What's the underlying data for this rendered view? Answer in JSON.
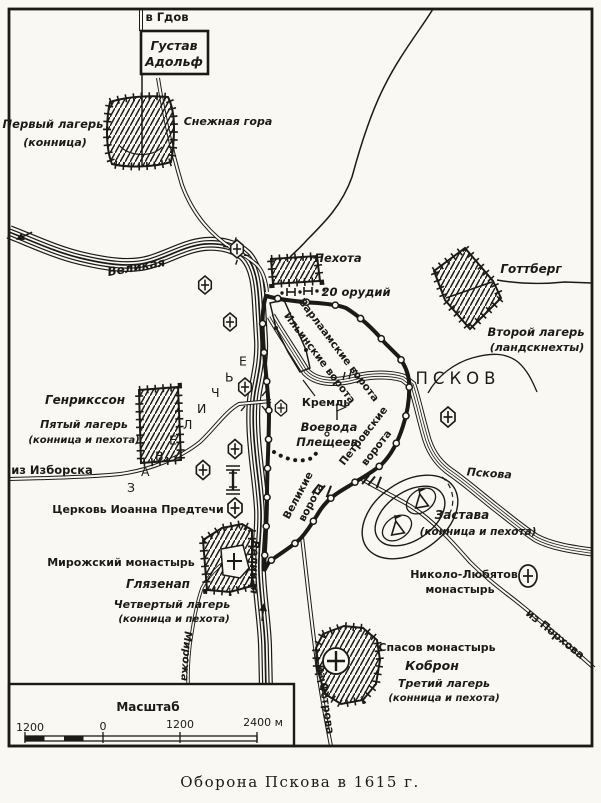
{
  "caption": "Оборона Пскова в 1615 г.",
  "map": {
    "roads": {
      "gdov": "в Гдов",
      "izborsk": "из Изборска",
      "ostrov": "из Острова",
      "porkhov": "из Порхова"
    },
    "rivers": {
      "velikaya": "Великая",
      "pskova": "Пскова",
      "mirozha": "Мирожа"
    },
    "city": {
      "name": "ПСКОВ",
      "kreml": "Кремль",
      "district": "ЗАВЕЛИЧЬЕ",
      "voevoda": {
        "line1": "Воевода",
        "line2": "Плещеев"
      }
    },
    "gates": {
      "varlaam": "Варлаамские ворота",
      "ilyinsk": "Ильинские ворота",
      "petrov": {
        "line1": "Петровские",
        "line2": "ворота"
      },
      "velikie": {
        "line1": "Великие",
        "line2": "ворота"
      }
    },
    "camps": {
      "hq": {
        "line1": "Густав",
        "line2": "Адольф"
      },
      "first": {
        "name": "Первый лагерь",
        "type": "(конница)"
      },
      "second": {
        "commander": "Готтберг",
        "name": "Второй лагерь",
        "type": "(ландскнехты)"
      },
      "third": {
        "commander": "Коброн",
        "name": "Третий лагерь",
        "type": "(конница и пехота)",
        "landmark": "Спасов монастырь"
      },
      "fourth": {
        "commander": "Глязенап",
        "name": "Четвертый лагерь",
        "type": "(конница и пехота)",
        "landmark": "Мирожский монастырь"
      },
      "fifth": {
        "commander": "Генрикссон",
        "name": "Пятый лагерь",
        "type": "(конница и пехота)"
      },
      "infantry": {
        "name": "Пехота",
        "guns": "20 орудий"
      },
      "outpost": {
        "name": "Застава",
        "type": "(конница и пехота)"
      }
    },
    "landmarks": {
      "snezhnaya": "Снежная гора",
      "church_john": "Церковь Иоанна Предтечи",
      "nikolo": {
        "line1": "Николо-Любятов",
        "line2": "монастырь"
      }
    },
    "scale": {
      "title": "Масштаб",
      "ticks": [
        "1200",
        "0",
        "1200",
        "2400 м"
      ]
    },
    "colors": {
      "ink": "#1c1a17",
      "paper": "#faf8f3"
    }
  }
}
